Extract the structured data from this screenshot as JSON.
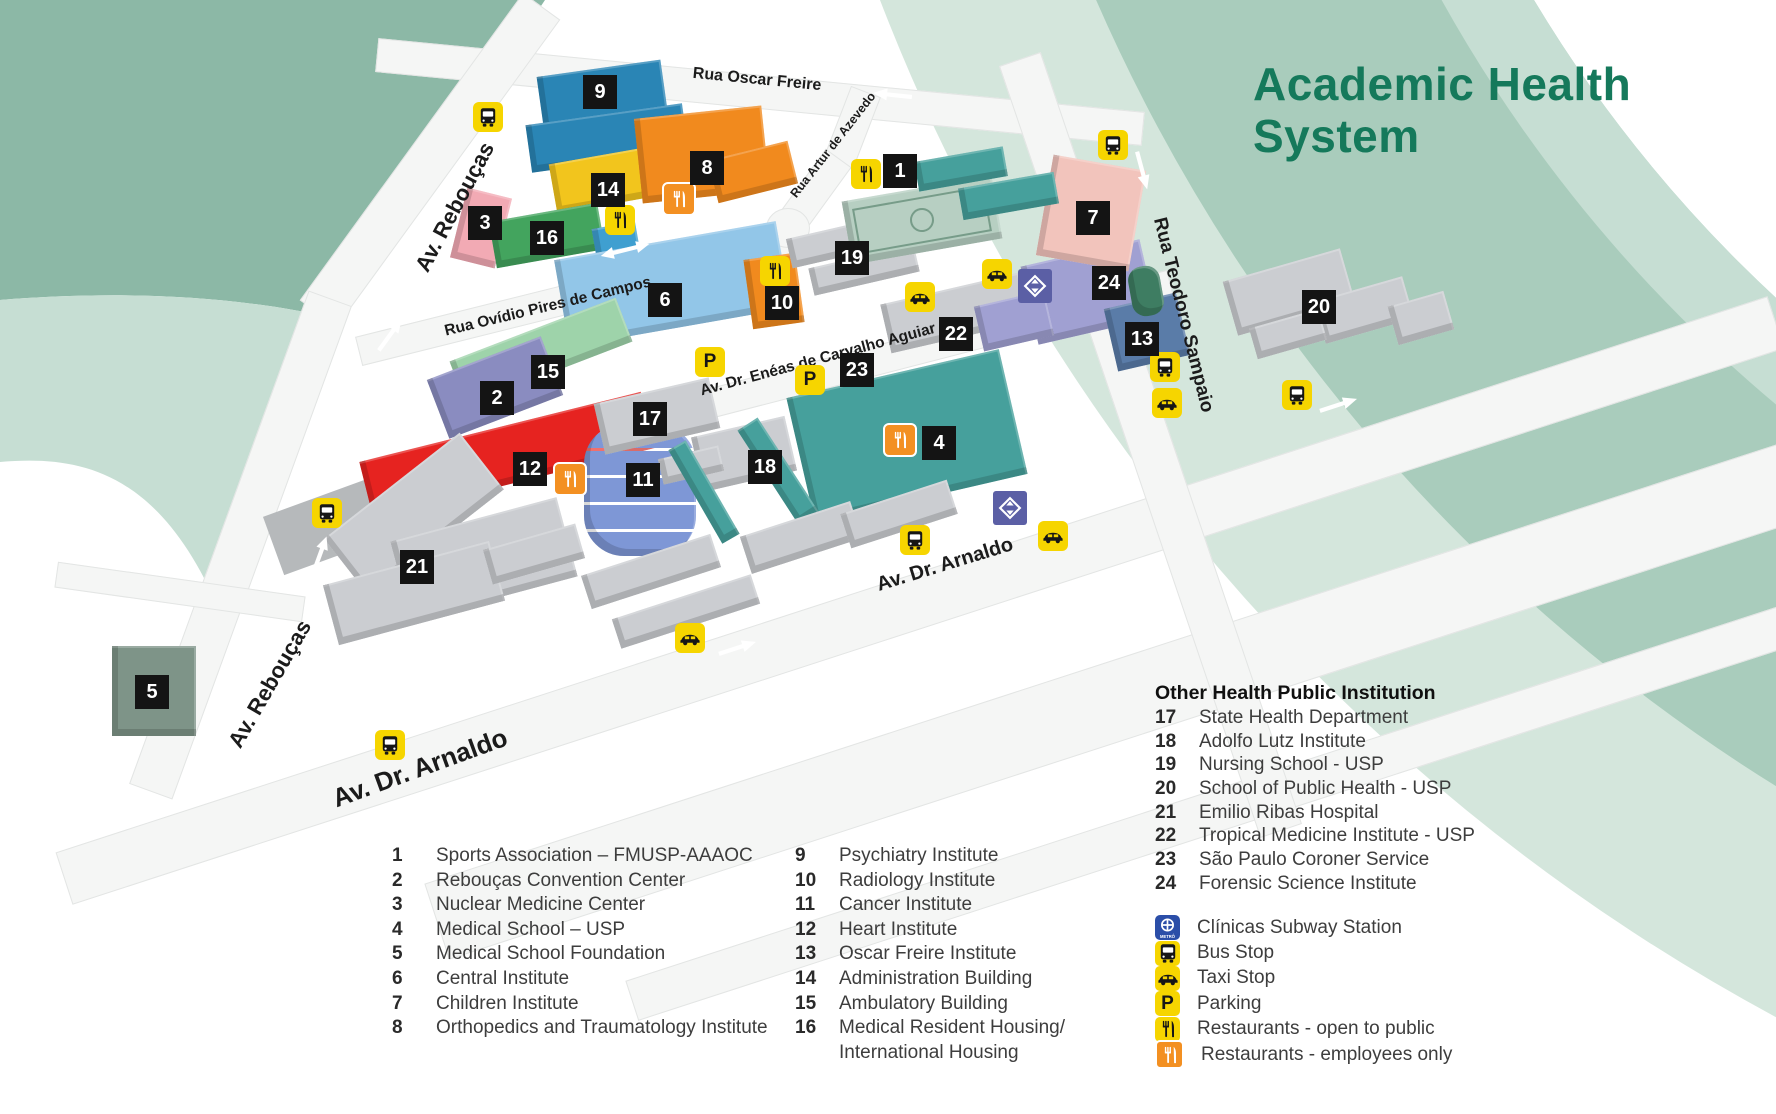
{
  "title": {
    "text": "Academic Health System",
    "color": "#15795b"
  },
  "accents": {
    "icon_yellow": "#f6d500",
    "icon_orange": "#f39022",
    "subway_map_purple": "#5b5fa5",
    "subway_legend_blue": "#2b4ea8",
    "marker_black": "#141414",
    "swoosh_dark": "#8cb8a6",
    "swoosh_medium": "#a9ccbc",
    "swoosh_light": "#c6ded3",
    "swoosh_pale": "#d4e6dc"
  },
  "map": {
    "streets": [
      {
        "name": "Rua Oscar Freire",
        "x": 757,
        "y": 80,
        "rot": 5.5,
        "size": 16
      },
      {
        "name": "Av. Rebouças",
        "x": 455,
        "y": 207,
        "rot": -62,
        "size": 22
      },
      {
        "name": "Rua Ovídio Pires de Campos",
        "x": 548,
        "y": 307,
        "rot": -13.5,
        "size": 15.5
      },
      {
        "name": "Rua Artur de Azevedo",
        "x": 833,
        "y": 145,
        "rot": -52,
        "size": 12.5
      },
      {
        "name": "Av. Dr. Enéas de Carvalho Aguiar",
        "x": 818,
        "y": 360,
        "rot": -15,
        "size": 15.5
      },
      {
        "name": "Av. Dr. Arnaldo",
        "x": 945,
        "y": 565,
        "rot": -17,
        "size": 20
      },
      {
        "name": "Av. Dr. Arnaldo",
        "x": 420,
        "y": 768,
        "rot": -20,
        "size": 26
      },
      {
        "name": "Av. Rebouças",
        "x": 270,
        "y": 684,
        "rot": -60,
        "size": 22
      },
      {
        "name": "Rua Teodoro Sampaio",
        "x": 1183,
        "y": 315,
        "rot": 76,
        "size": 19
      }
    ],
    "markers": [
      {
        "n": 1,
        "x": 900,
        "y": 171
      },
      {
        "n": 2,
        "x": 497,
        "y": 398
      },
      {
        "n": 3,
        "x": 485,
        "y": 223
      },
      {
        "n": 4,
        "x": 939,
        "y": 443
      },
      {
        "n": 5,
        "x": 152,
        "y": 692
      },
      {
        "n": 6,
        "x": 665,
        "y": 300
      },
      {
        "n": 7,
        "x": 1093,
        "y": 218
      },
      {
        "n": 8,
        "x": 707,
        "y": 168
      },
      {
        "n": 9,
        "x": 600,
        "y": 92
      },
      {
        "n": 10,
        "x": 782,
        "y": 303
      },
      {
        "n": 11,
        "x": 643,
        "y": 480
      },
      {
        "n": 12,
        "x": 530,
        "y": 469
      },
      {
        "n": 13,
        "x": 1142,
        "y": 339
      },
      {
        "n": 14,
        "x": 608,
        "y": 190
      },
      {
        "n": 15,
        "x": 548,
        "y": 372
      },
      {
        "n": 16,
        "x": 547,
        "y": 238
      },
      {
        "n": 17,
        "x": 650,
        "y": 419
      },
      {
        "n": 18,
        "x": 765,
        "y": 467
      },
      {
        "n": 19,
        "x": 852,
        "y": 258
      },
      {
        "n": 20,
        "x": 1319,
        "y": 307
      },
      {
        "n": 21,
        "x": 417,
        "y": 567
      },
      {
        "n": 22,
        "x": 956,
        "y": 334
      },
      {
        "n": 23,
        "x": 857,
        "y": 370
      },
      {
        "n": 24,
        "x": 1109,
        "y": 283
      }
    ],
    "icons": [
      {
        "t": "bus",
        "x": 488,
        "y": 117
      },
      {
        "t": "bus",
        "x": 1113,
        "y": 145
      },
      {
        "t": "bus",
        "x": 1165,
        "y": 367
      },
      {
        "t": "bus",
        "x": 1297,
        "y": 395
      },
      {
        "t": "bus",
        "x": 327,
        "y": 513
      },
      {
        "t": "bus",
        "x": 390,
        "y": 745
      },
      {
        "t": "bus",
        "x": 915,
        "y": 540
      },
      {
        "t": "taxi",
        "x": 920,
        "y": 297
      },
      {
        "t": "taxi",
        "x": 997,
        "y": 274
      },
      {
        "t": "taxi",
        "x": 1167,
        "y": 403
      },
      {
        "t": "taxi",
        "x": 1053,
        "y": 536
      },
      {
        "t": "taxi",
        "x": 690,
        "y": 638
      },
      {
        "t": "parking",
        "x": 710,
        "y": 362
      },
      {
        "t": "parking",
        "x": 810,
        "y": 380
      },
      {
        "t": "rest-public",
        "x": 620,
        "y": 220
      },
      {
        "t": "rest-public",
        "x": 866,
        "y": 174
      },
      {
        "t": "rest-public",
        "x": 775,
        "y": 271
      },
      {
        "t": "rest-staff",
        "x": 677,
        "y": 197
      },
      {
        "t": "rest-staff",
        "x": 568,
        "y": 477
      },
      {
        "t": "rest-staff",
        "x": 898,
        "y": 438
      },
      {
        "t": "subway",
        "x": 1035,
        "y": 286
      },
      {
        "t": "subway",
        "x": 1010,
        "y": 508
      },
      {
        "t": "arrow",
        "x": 893,
        "y": 95,
        "rot": 186
      },
      {
        "t": "arrow",
        "x": 1142,
        "y": 170,
        "rot": 75
      },
      {
        "t": "arrow",
        "x": 390,
        "y": 335,
        "rot": -54
      },
      {
        "t": "arrow",
        "x": 737,
        "y": 648,
        "rot": -18
      },
      {
        "t": "arrow",
        "x": 1338,
        "y": 405,
        "rot": -18
      },
      {
        "t": "arrow-two",
        "x": 625,
        "y": 250,
        "rot": -14
      },
      {
        "t": "arrow-two",
        "x": 318,
        "y": 560,
        "rot": -70
      }
    ],
    "buildings": [
      {
        "b": 9,
        "c": "#2a85b5",
        "x": 540,
        "y": 68,
        "w": 125,
        "h": 58,
        "r": -8
      },
      {
        "b": 9,
        "c": "#2a85b5",
        "x": 528,
        "y": 114,
        "w": 158,
        "h": 48,
        "r": -8
      },
      {
        "b": 14,
        "c": "#f2c51d",
        "x": 552,
        "y": 152,
        "w": 138,
        "h": 50,
        "r": -10
      },
      {
        "b": 8,
        "c": "#f18a1e",
        "x": 638,
        "y": 112,
        "w": 128,
        "h": 85,
        "r": -6
      },
      {
        "b": 8,
        "c": "#f18a1e",
        "x": 712,
        "y": 150,
        "w": 82,
        "h": 44,
        "r": -14
      },
      {
        "b": 3,
        "c": "#f2aab4",
        "x": 458,
        "y": 192,
        "w": 46,
        "h": 72,
        "r": 14
      },
      {
        "b": 16,
        "c": "#43a45e",
        "x": 492,
        "y": 212,
        "w": 110,
        "h": 47,
        "r": -10
      },
      {
        "b": 16,
        "c": "#3f9fd0",
        "x": 594,
        "y": 225,
        "w": 44,
        "h": 32,
        "r": -10
      },
      {
        "b": 6,
        "c": "#92c6e8",
        "x": 560,
        "y": 240,
        "w": 225,
        "h": 88,
        "r": -10
      },
      {
        "b": 10,
        "c": "#f18a1e",
        "x": 748,
        "y": 256,
        "w": 52,
        "h": 70,
        "r": -8
      },
      {
        "b": 15,
        "c": "#9ed3aa",
        "x": 452,
        "y": 328,
        "w": 178,
        "h": 47,
        "r": -21
      },
      {
        "b": 2,
        "c": "#8a8cc0",
        "x": 434,
        "y": 356,
        "w": 122,
        "h": 63,
        "r": -21
      },
      {
        "b": 12,
        "c": "#e62320",
        "x": 362,
        "y": 426,
        "w": 290,
        "h": 58,
        "r": -14
      },
      {
        "b": 11,
        "c": "#7e97d6",
        "x": 584,
        "y": 424,
        "w": 112,
        "h": 132,
        "r": 0,
        "shape": "cyl"
      },
      {
        "b": 17,
        "c": "#cbcdd1",
        "x": 598,
        "y": 390,
        "w": 118,
        "h": 52,
        "r": -13
      },
      {
        "b": 18,
        "c": "#cbcdd1",
        "x": 696,
        "y": 426,
        "w": 96,
        "h": 56,
        "r": -13
      },
      {
        "b": 18,
        "c": "#cbcdd1",
        "x": 660,
        "y": 452,
        "w": 62,
        "h": 26,
        "r": -13
      },
      {
        "b": 4,
        "c": "#46a09c",
        "x": 798,
        "y": 372,
        "w": 218,
        "h": 128,
        "r": -13
      },
      {
        "b": 4,
        "c": "#46a09c",
        "x": 766,
        "y": 415,
        "w": 24,
        "h": 112,
        "r": -33
      },
      {
        "b": 4,
        "c": "#46a09c",
        "x": 694,
        "y": 438,
        "w": 20,
        "h": 108,
        "r": -30
      },
      {
        "b": 22,
        "c": "#cbcdd1",
        "x": 884,
        "y": 288,
        "w": 142,
        "h": 50,
        "r": -13
      },
      {
        "b": 19,
        "c": "#cbcdd1",
        "x": 788,
        "y": 228,
        "w": 96,
        "h": 30,
        "r": -13
      },
      {
        "b": 19,
        "c": "#cbcdd1",
        "x": 810,
        "y": 256,
        "w": 108,
        "h": 28,
        "r": -13
      },
      {
        "b": 24,
        "c": "#a0a0d2",
        "x": 1028,
        "y": 252,
        "w": 122,
        "h": 80,
        "r": -13
      },
      {
        "b": 24,
        "c": "#a0a0d2",
        "x": 978,
        "y": 298,
        "w": 72,
        "h": 46,
        "r": -13
      },
      {
        "b": 13,
        "c": "#5a7ca8",
        "x": 1110,
        "y": 300,
        "w": 74,
        "h": 64,
        "r": -13
      },
      {
        "b": 7,
        "c": "#f2c4bc",
        "x": 1044,
        "y": 162,
        "w": 94,
        "h": 102,
        "r": 10
      },
      {
        "b": 20,
        "c": "#cbcdd1",
        "x": 1228,
        "y": 264,
        "w": 122,
        "h": 56,
        "r": -16
      },
      {
        "b": 20,
        "c": "#cbcdd1",
        "x": 1318,
        "y": 288,
        "w": 92,
        "h": 44,
        "r": -16
      },
      {
        "b": 20,
        "c": "#cbcdd1",
        "x": 1392,
        "y": 298,
        "w": 58,
        "h": 40,
        "r": -16
      },
      {
        "b": 20,
        "c": "#cbcdd1",
        "x": 1252,
        "y": 318,
        "w": 72,
        "h": 32,
        "r": -16
      },
      {
        "b": 21,
        "c": "#cbcdd1",
        "x": 328,
        "y": 478,
        "w": 172,
        "h": 72,
        "r": -38
      },
      {
        "b": 21,
        "c": "#cbcdd1",
        "x": 398,
        "y": 518,
        "w": 172,
        "h": 82,
        "r": -15
      },
      {
        "b": 21,
        "c": "#cbcdd1",
        "x": 328,
        "y": 562,
        "w": 172,
        "h": 62,
        "r": -15
      },
      {
        "b": 5,
        "c": "#7e9488",
        "x": 112,
        "y": 646,
        "w": 84,
        "h": 90,
        "r": 0
      },
      {
        "b": 1,
        "c": "#b7cfc2",
        "x": 846,
        "y": 188,
        "w": 152,
        "h": 64,
        "r": -10,
        "shape": "field"
      },
      {
        "b": 1,
        "c": "#46a09c",
        "x": 916,
        "y": 154,
        "w": 90,
        "h": 30,
        "r": -10
      },
      {
        "b": 1,
        "c": "#46a09c",
        "x": 960,
        "y": 180,
        "w": 97,
        "h": 32,
        "r": -10
      },
      {
        "c": "#cbcdd1",
        "x": 486,
        "y": 536,
        "w": 96,
        "h": 36,
        "r": -16
      },
      {
        "c": "#cbcdd1",
        "x": 583,
        "y": 554,
        "w": 136,
        "h": 35,
        "r": -18
      },
      {
        "c": "#cbcdd1",
        "x": 613,
        "y": 596,
        "w": 146,
        "h": 31,
        "r": -18
      },
      {
        "c": "#cbcdd1",
        "x": 743,
        "y": 518,
        "w": 116,
        "h": 39,
        "r": -18
      },
      {
        "c": "#cbcdd1",
        "x": 843,
        "y": 496,
        "w": 112,
        "h": 36,
        "r": -18
      },
      {
        "c": "#3e7d62",
        "x": 1130,
        "y": 266,
        "w": 32,
        "h": 50,
        "r": -10,
        "rad": 14
      }
    ]
  },
  "legend": {
    "columns": [
      {
        "items": [
          {
            "n": 1,
            "label": "Sports Association – FMUSP-AAAOC"
          },
          {
            "n": 2,
            "label": "Rebouças Convention Center"
          },
          {
            "n": 3,
            "label": "Nuclear Medicine Center"
          },
          {
            "n": 4,
            "label": "Medical School – USP"
          },
          {
            "n": 5,
            "label": "Medical School Foundation"
          },
          {
            "n": 6,
            "label": "Central Institute"
          },
          {
            "n": 7,
            "label": "Children Institute"
          },
          {
            "n": 8,
            "label": "Orthopedics and Traumatology Institute"
          }
        ]
      },
      {
        "items": [
          {
            "n": 9,
            "label": "Psychiatry Institute"
          },
          {
            "n": 10,
            "label": "Radiology Institute"
          },
          {
            "n": 11,
            "label": "Cancer Institute"
          },
          {
            "n": 12,
            "label": "Heart Institute"
          },
          {
            "n": 13,
            "label": "Oscar Freire Institute"
          },
          {
            "n": 14,
            "label": "Administration Building"
          },
          {
            "n": 15,
            "label": "Ambulatory Building"
          },
          {
            "n": 16,
            "label": "Medical Resident Housing/",
            "label2": "International Housing"
          }
        ]
      },
      {
        "title": "Other Health Public Institution",
        "items": [
          {
            "n": 17,
            "label": "State Health Department"
          },
          {
            "n": 18,
            "label": "Adolfo Lutz Institute"
          },
          {
            "n": 19,
            "label": "Nursing School - USP"
          },
          {
            "n": 20,
            "label": "School of Public Health - USP"
          },
          {
            "n": 21,
            "label": "Emilio Ribas Hospital"
          },
          {
            "n": 22,
            "label": "Tropical Medicine Institute - USP"
          },
          {
            "n": 23,
            "label": "São Paulo Coroner Service"
          },
          {
            "n": 24,
            "label": "Forensic Science Institute"
          }
        ]
      }
    ],
    "icons": [
      {
        "t": "subway-legend",
        "label": "Clínicas Subway Station"
      },
      {
        "t": "bus",
        "label": "Bus Stop"
      },
      {
        "t": "taxi",
        "label": "Taxi Stop"
      },
      {
        "t": "parking",
        "label": "Parking"
      },
      {
        "t": "rest-public",
        "label": "Restaurants - open to public"
      },
      {
        "t": "rest-staff",
        "label": "Restaurants - employees only"
      }
    ],
    "subway_text": "METRÔ"
  }
}
